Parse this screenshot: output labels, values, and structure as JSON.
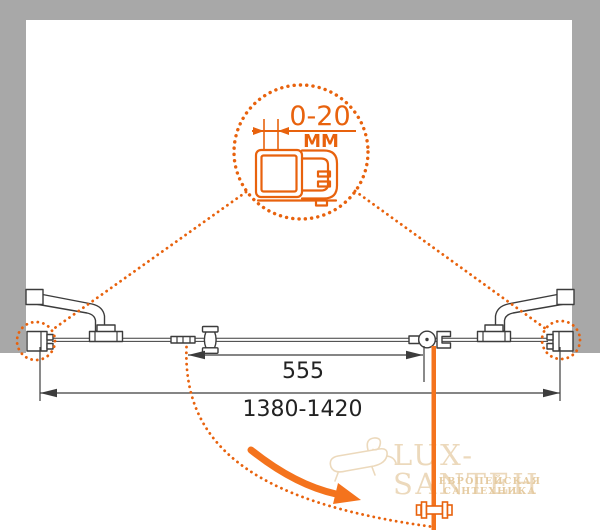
{
  "colors": {
    "accent": "#e8620d",
    "accentBright": "#f4731d",
    "wall": "#a8a8a8",
    "ink": "#3c3c3c",
    "dimInk": "#222222",
    "watermark": "#ecd9bc",
    "watermarkSub": "#e5cba1",
    "canvas": "#ffffff"
  },
  "detail_callout": {
    "range_label": "0-20",
    "unit_label": "ММ"
  },
  "dimensions": {
    "door_width_label": "555",
    "overall_width_label": "1380-1420"
  },
  "watermark": {
    "brand": "LUX-SANTEH",
    "tagline": "ЕВРОПЕЙСКАЯ САНТЕХНИКА"
  }
}
